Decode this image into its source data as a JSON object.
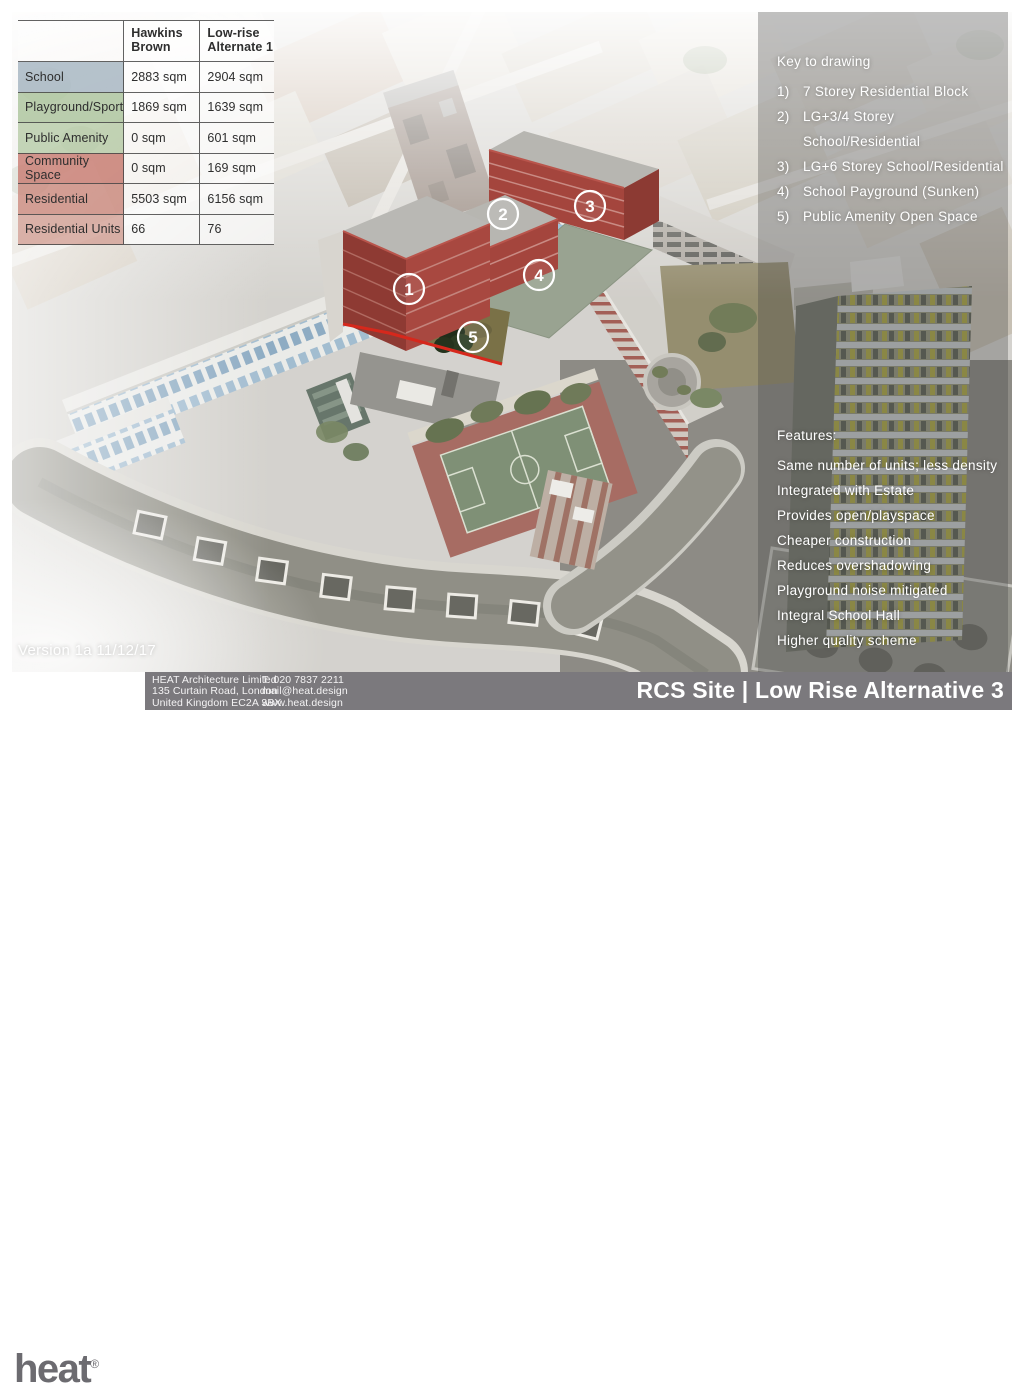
{
  "comparison_table": {
    "headers": [
      "Hawkins Brown",
      "Low-rise Alternate 1"
    ],
    "rows": [
      {
        "label": "School",
        "values": [
          "2883 sqm",
          "2904 sqm"
        ],
        "tint": "rgba(164,180,193,0.8)"
      },
      {
        "label": "Playground/Sport",
        "values": [
          "1869 sqm",
          "1639 sqm"
        ],
        "tint": "rgba(170,195,155,0.8)"
      },
      {
        "label": "Public Amenity",
        "values": [
          "0 sqm",
          "601 sqm"
        ],
        "tint": "rgba(183,204,168,0.8)"
      },
      {
        "label": "Community Space",
        "values": [
          "0 sqm",
          "169 sqm"
        ],
        "tint": "rgba(200,123,112,0.8)"
      },
      {
        "label": "Residential",
        "values": [
          "5503 sqm",
          "6156 sqm"
        ],
        "tint": "rgba(204,137,126,0.8)"
      },
      {
        "label": "Residential Units",
        "values": [
          "66",
          "76"
        ],
        "tint": "rgba(210,156,146,0.75)"
      }
    ]
  },
  "key_panel": {
    "title": "Key to drawing",
    "items": [
      {
        "num": "1)",
        "label": "7 Storey Residential Block"
      },
      {
        "num": "2)",
        "label": "LG+3/4 Storey School/Residential"
      },
      {
        "num": "3)",
        "label": "LG+6 Storey School/Residential"
      },
      {
        "num": "4)",
        "label": "School Payground (Sunken)"
      },
      {
        "num": "5)",
        "label": "Public Amenity Open Space"
      }
    ]
  },
  "features_panel": {
    "title": "Features:",
    "items": [
      "Same number of units; less density",
      "Integrated with Estate",
      "Provides open/playspace",
      "Cheaper construction",
      "Reduces overshadowing",
      "Playground noise mitigated",
      "Integral School Hall",
      "Higher quality scheme"
    ]
  },
  "version_label": "Version 1a 11/12/17",
  "footer": {
    "logo_text": "heat",
    "registered_mark": "®",
    "company_lines": [
      "HEAT Architecture Limited",
      "135 Curtain Road, London",
      "United Kingdom EC2A 3BX"
    ],
    "contact_lines": [
      "T:  020 7837 2211",
      "mail@heat.design",
      "www.heat.design"
    ],
    "sheet_title": "RCS Site | Low Rise Alternative 3"
  },
  "site_plan": {
    "markers": [
      {
        "num": "1",
        "x": 409,
        "y": 289
      },
      {
        "num": "2",
        "x": 503,
        "y": 214
      },
      {
        "num": "3",
        "x": 590,
        "y": 206
      },
      {
        "num": "4",
        "x": 539,
        "y": 275
      },
      {
        "num": "5",
        "x": 473,
        "y": 337
      }
    ],
    "colors": {
      "massing_red": "#a4453d",
      "massing_red_dark": "#8c3a33",
      "massing_roof_grey": "#b7b6b1",
      "sunken_wall_blue": "#aacde0",
      "playground_deck": "#99a391",
      "site_boundary_red": "#d6281c",
      "marker_ring": "#ffffff"
    }
  },
  "colors": {
    "right_overlay": "rgba(64,64,66,0.32)",
    "footer_bar_grey": "#7b797d",
    "logo_grey": "#6c6b70",
    "table_text": "#2e2e2e",
    "panel_text": "#ffffff"
  }
}
